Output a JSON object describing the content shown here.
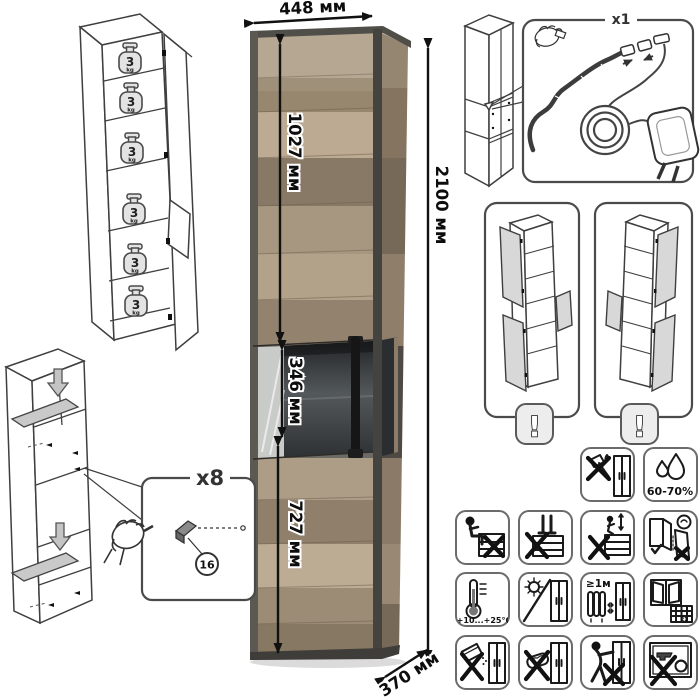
{
  "product": {
    "type": "tall-display-cabinet"
  },
  "dimensions": {
    "width": "448 мм",
    "height": "2100 мм",
    "upper_door": "1027 мм",
    "glass_niche": "346 мм",
    "lower_door": "727 мм",
    "depth": "370 мм"
  },
  "shelf_load": {
    "value": "3",
    "unit": "kg",
    "shelf_count": 6
  },
  "led_kit": {
    "quantity": "x1"
  },
  "assembly": {
    "fastener_quantity": "x8",
    "part_number": "16"
  },
  "warnings": {
    "exclamation": "!"
  },
  "care": {
    "humidity": "60-70%",
    "temperature": "+10...+25°C",
    "heater_distance": "≥1м",
    "calendar_day": "21"
  },
  "colors": {
    "wood_light": "#bcab92",
    "wood_mid": "#a89780",
    "wood_dark": "#887966",
    "frame_dark": "#4e4c47",
    "glass_dark": "#34383b",
    "handle_black": "#161616",
    "lineart_gray": "#3f3f3f"
  }
}
